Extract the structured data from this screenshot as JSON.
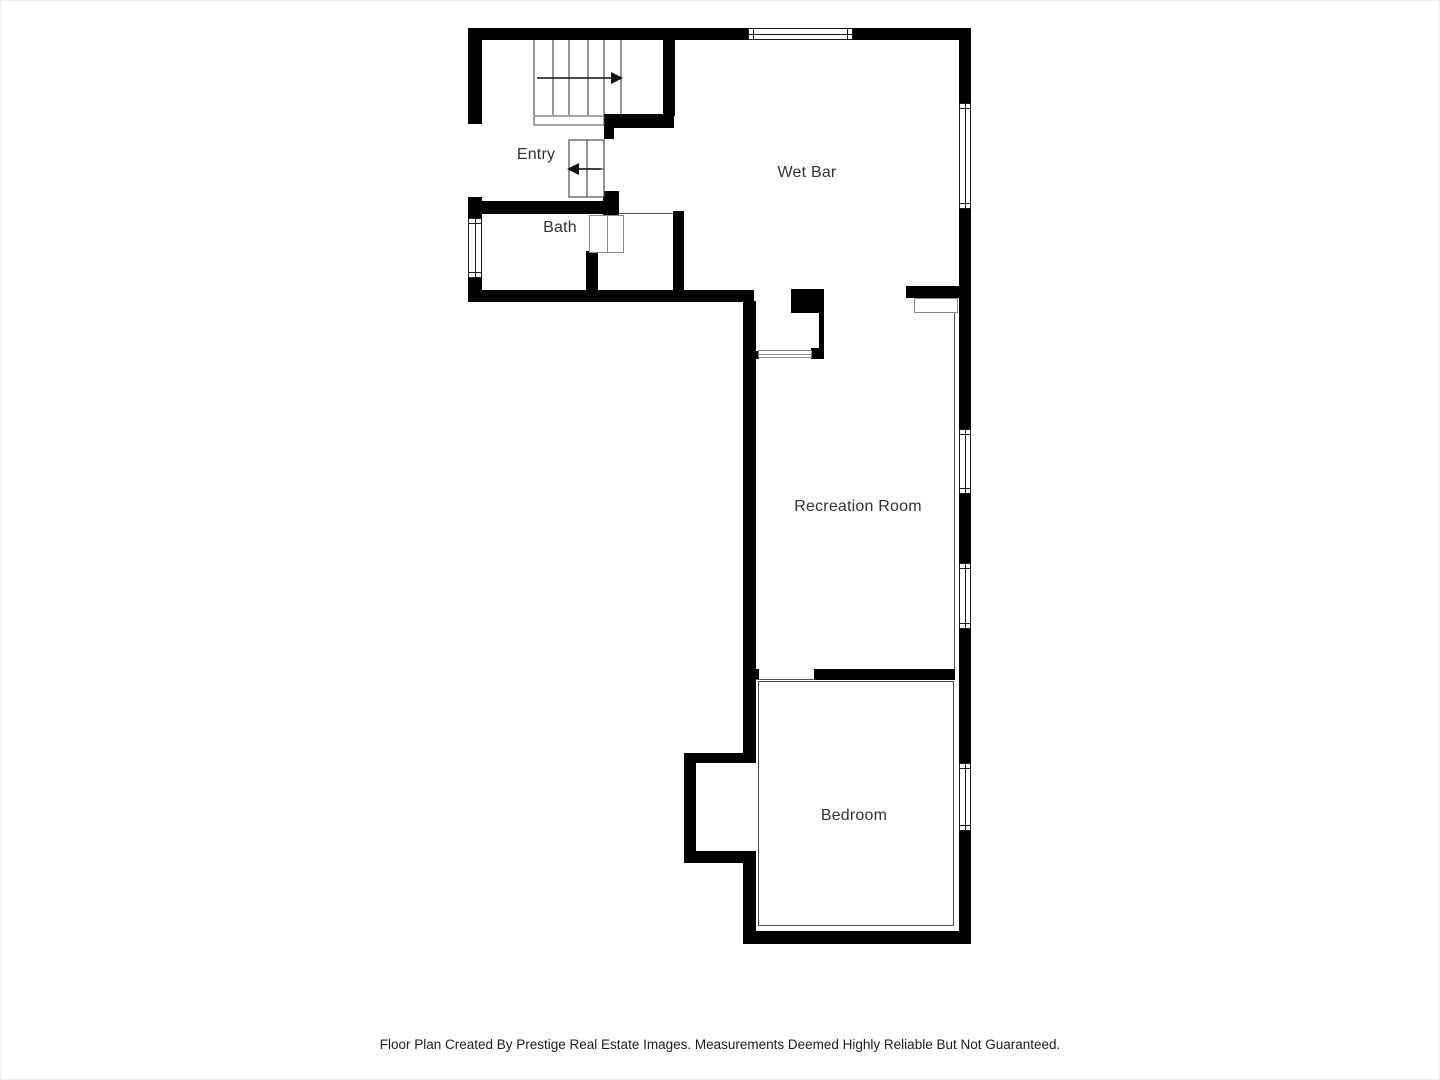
{
  "floor_plan": {
    "rooms": [
      {
        "label": "Entry"
      },
      {
        "label": "Bath"
      },
      {
        "label": "Wet Bar"
      },
      {
        "label": "Recreation Room"
      },
      {
        "label": "Bedroom"
      }
    ],
    "features": {
      "staircase_up": "staircase with arrow pointing right",
      "staircase_entry": "entry steps with arrow pointing left",
      "window_count": 6,
      "door_symbols": [
        "bath-door",
        "wet-bar-sliding-door",
        "closet-door"
      ]
    },
    "colors": {
      "wall": "#000000",
      "background": "#ffffff",
      "thin_line": "#555555",
      "label_text": "#333333"
    },
    "footer": {
      "disclaimer": "Floor Plan Created By Prestige Real Estate Images. Measurements Deemed Highly Reliable But Not Guaranteed."
    }
  }
}
